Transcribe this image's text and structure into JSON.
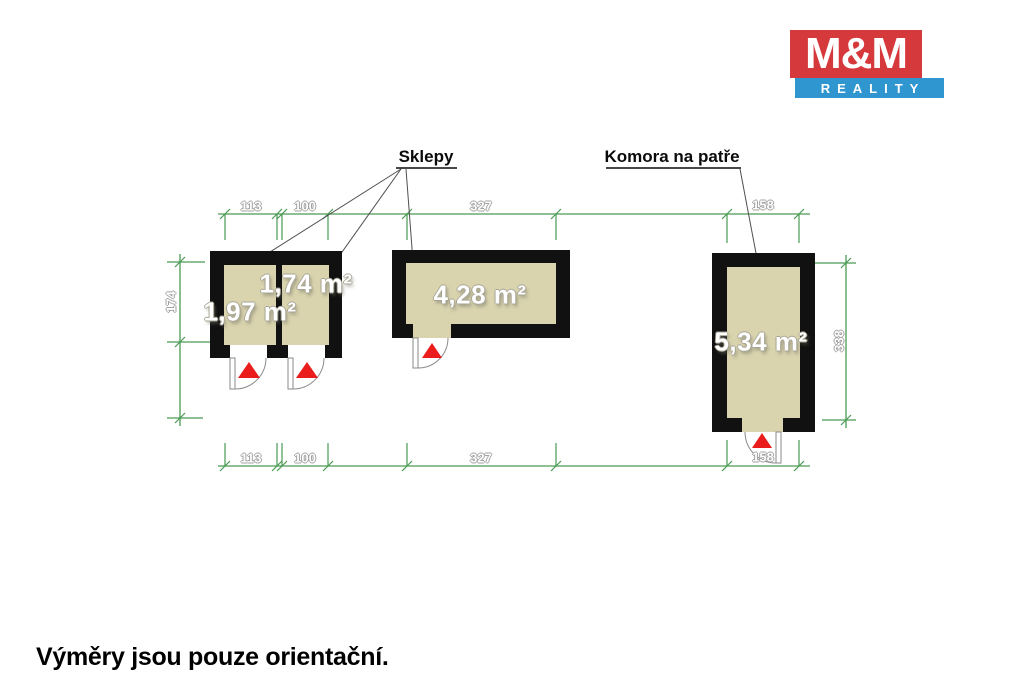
{
  "brand": {
    "name_top": "M&M",
    "name_bottom": "REALITY",
    "red": "#d6393b",
    "blue": "#3096d0"
  },
  "annotations": {
    "sklepy_label": "Sklepy",
    "komora_label": "Komora na patře",
    "disclaimer": "Výměry jsou pouze orientační."
  },
  "rooms": [
    {
      "id": "sklep-1",
      "area": "1,97 m²"
    },
    {
      "id": "sklep-2",
      "area": "1,74 m²"
    },
    {
      "id": "sklep-3",
      "area": "4,28 m²"
    },
    {
      "id": "komora-na-patre",
      "area": "5,34 m²"
    }
  ],
  "dimensions_cm": {
    "top": [
      "113",
      "100",
      "327",
      "158"
    ],
    "bottom": [
      "113",
      "100",
      "327",
      "158"
    ],
    "left": "174",
    "right": "338"
  },
  "colors": {
    "dimension_green": "#4a9b53",
    "wall": "#111111",
    "floor": "#d9d3ae",
    "door_swing_red": "#ea1c1c"
  }
}
